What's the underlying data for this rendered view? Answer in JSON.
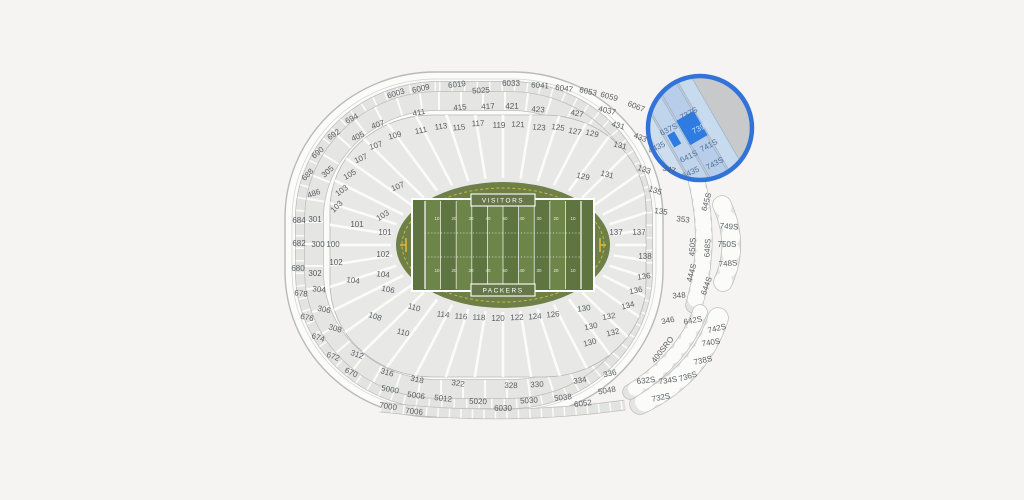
{
  "canvas": {
    "background": "#f5f4f2",
    "section_block_color": "#e4e4e2",
    "section_outline_color": "#bdbdbd",
    "label_color": "#5a5e63"
  },
  "field": {
    "visitors_label": "VISITORS",
    "packers_label": "PACKERS",
    "oval_color": "#6e8048",
    "stripe_dark": "#5e7441",
    "stripe_light": "#6e8549",
    "dashed_border_color": "#c9b93f",
    "goalpost_color": "#ddba3a"
  },
  "highlight": {
    "selected_section": "739S",
    "selected_fill": "#2e7ce1",
    "ring_color": "#3173d9",
    "tint_fill": "#b9cfe9",
    "tint_fill_alt": "#c6d8ee",
    "outside_gray": "#c7c9ca",
    "center_x": 700,
    "center_y": 128,
    "radius": 52
  },
  "labels": [
    {
      "t": "6003",
      "x": 396,
      "y": 94,
      "r": -18
    },
    {
      "t": "6009",
      "x": 421,
      "y": 89,
      "r": -13
    },
    {
      "t": "6019",
      "x": 457,
      "y": 85,
      "r": -7
    },
    {
      "t": "5025",
      "x": 481,
      "y": 91,
      "r": -3
    },
    {
      "t": "6033",
      "x": 511,
      "y": 84,
      "r": 0
    },
    {
      "t": "6041",
      "x": 540,
      "y": 86,
      "r": 4
    },
    {
      "t": "6047",
      "x": 564,
      "y": 89,
      "r": 8
    },
    {
      "t": "6053",
      "x": 588,
      "y": 92,
      "r": 12
    },
    {
      "t": "6059",
      "x": 609,
      "y": 97,
      "r": 16
    },
    {
      "t": "6067",
      "x": 636,
      "y": 107,
      "r": 22
    },
    {
      "t": "405",
      "x": 358,
      "y": 137,
      "r": -24
    },
    {
      "t": "407",
      "x": 378,
      "y": 125,
      "r": -18
    },
    {
      "t": "411",
      "x": 419,
      "y": 113,
      "r": -11
    },
    {
      "t": "415",
      "x": 460,
      "y": 108,
      "r": -6
    },
    {
      "t": "417",
      "x": 488,
      "y": 107,
      "r": -3
    },
    {
      "t": "421",
      "x": 512,
      "y": 107,
      "r": 0
    },
    {
      "t": "423",
      "x": 538,
      "y": 110,
      "r": 4
    },
    {
      "t": "427",
      "x": 577,
      "y": 114,
      "r": 9
    },
    {
      "t": "4037",
      "x": 607,
      "y": 111,
      "r": 13
    },
    {
      "t": "431",
      "x": 618,
      "y": 126,
      "r": 16
    },
    {
      "t": "433",
      "x": 640,
      "y": 138,
      "r": 22
    },
    {
      "t": "694",
      "x": 352,
      "y": 119,
      "r": -28
    },
    {
      "t": "692",
      "x": 334,
      "y": 135,
      "r": -34
    },
    {
      "t": "690",
      "x": 318,
      "y": 153,
      "r": -40
    },
    {
      "t": "688",
      "x": 308,
      "y": 175,
      "r": -46
    },
    {
      "t": "486",
      "x": 314,
      "y": 194,
      "r": -20
    },
    {
      "t": "684",
      "x": 299,
      "y": 221,
      "r": 0
    },
    {
      "t": "682",
      "x": 299,
      "y": 244,
      "r": 0
    },
    {
      "t": "680",
      "x": 298,
      "y": 269,
      "r": 0
    },
    {
      "t": "678",
      "x": 301,
      "y": 294,
      "r": 6
    },
    {
      "t": "676",
      "x": 307,
      "y": 318,
      "r": 12
    },
    {
      "t": "674",
      "x": 318,
      "y": 338,
      "r": 18
    },
    {
      "t": "672",
      "x": 333,
      "y": 357,
      "r": 22
    },
    {
      "t": "670",
      "x": 351,
      "y": 373,
      "r": 25
    },
    {
      "t": "305",
      "x": 328,
      "y": 172,
      "r": -42
    },
    {
      "t": "301",
      "x": 315,
      "y": 220,
      "r": 0
    },
    {
      "t": "300",
      "x": 318,
      "y": 245,
      "r": 0
    },
    {
      "t": "302",
      "x": 315,
      "y": 274,
      "r": 0
    },
    {
      "t": "304",
      "x": 319,
      "y": 290,
      "r": 6
    },
    {
      "t": "306",
      "x": 324,
      "y": 310,
      "r": 12
    },
    {
      "t": "308",
      "x": 335,
      "y": 329,
      "r": 16
    },
    {
      "t": "312",
      "x": 357,
      "y": 355,
      "r": 20
    },
    {
      "t": "316",
      "x": 387,
      "y": 373,
      "r": 17
    },
    {
      "t": "318",
      "x": 417,
      "y": 380,
      "r": 13
    },
    {
      "t": "322",
      "x": 458,
      "y": 384,
      "r": 8
    },
    {
      "t": "328",
      "x": 511,
      "y": 386,
      "r": 1
    },
    {
      "t": "330",
      "x": 537,
      "y": 385,
      "r": -3
    },
    {
      "t": "334",
      "x": 580,
      "y": 381,
      "r": -8
    },
    {
      "t": "336",
      "x": 610,
      "y": 374,
      "r": -12
    },
    {
      "t": "5000",
      "x": 390,
      "y": 390,
      "r": 11
    },
    {
      "t": "5006",
      "x": 416,
      "y": 396,
      "r": 8
    },
    {
      "t": "5012",
      "x": 443,
      "y": 399,
      "r": 6
    },
    {
      "t": "5020",
      "x": 478,
      "y": 402,
      "r": 2
    },
    {
      "t": "5030",
      "x": 529,
      "y": 401,
      "r": -3
    },
    {
      "t": "5038",
      "x": 563,
      "y": 398,
      "r": -6
    },
    {
      "t": "5048",
      "x": 607,
      "y": 391,
      "r": -10
    },
    {
      "t": "7000",
      "x": 388,
      "y": 407,
      "r": 9
    },
    {
      "t": "7006",
      "x": 414,
      "y": 412,
      "r": 6
    },
    {
      "t": "6030",
      "x": 503,
      "y": 409,
      "r": 0
    },
    {
      "t": "6052",
      "x": 583,
      "y": 404,
      "r": -7
    },
    {
      "t": "109",
      "x": 395,
      "y": 136,
      "r": -15
    },
    {
      "t": "111",
      "x": 421,
      "y": 131,
      "r": -11
    },
    {
      "t": "113",
      "x": 441,
      "y": 127,
      "r": -8
    },
    {
      "t": "115",
      "x": 459,
      "y": 128,
      "r": -5
    },
    {
      "t": "117",
      "x": 478,
      "y": 124,
      "r": -2
    },
    {
      "t": "119",
      "x": 499,
      "y": 126,
      "r": 0
    },
    {
      "t": "121",
      "x": 518,
      "y": 125,
      "r": 2
    },
    {
      "t": "123",
      "x": 539,
      "y": 128,
      "r": 5
    },
    {
      "t": "125",
      "x": 558,
      "y": 128,
      "r": 8
    },
    {
      "t": "127",
      "x": 575,
      "y": 132,
      "r": 11
    },
    {
      "t": "129",
      "x": 592,
      "y": 134,
      "r": 13
    },
    {
      "t": "107",
      "x": 376,
      "y": 146,
      "r": -18
    },
    {
      "t": "107",
      "x": 361,
      "y": 159,
      "r": -24
    },
    {
      "t": "105",
      "x": 350,
      "y": 175,
      "r": -30
    },
    {
      "t": "103",
      "x": 342,
      "y": 191,
      "r": -36
    },
    {
      "t": "103",
      "x": 337,
      "y": 207,
      "r": -44
    },
    {
      "t": "107",
      "x": 398,
      "y": 187,
      "r": -22
    },
    {
      "t": "103",
      "x": 383,
      "y": 216,
      "r": -32
    },
    {
      "t": "101",
      "x": 357,
      "y": 225,
      "r": 0
    },
    {
      "t": "101",
      "x": 385,
      "y": 233,
      "r": 0
    },
    {
      "t": "100",
      "x": 333,
      "y": 245,
      "r": 0
    },
    {
      "t": "102",
      "x": 336,
      "y": 263,
      "r": 0
    },
    {
      "t": "102",
      "x": 383,
      "y": 255,
      "r": 0
    },
    {
      "t": "104",
      "x": 353,
      "y": 281,
      "r": 8
    },
    {
      "t": "104",
      "x": 383,
      "y": 275,
      "r": 6
    },
    {
      "t": "106",
      "x": 388,
      "y": 290,
      "r": 12
    },
    {
      "t": "108",
      "x": 375,
      "y": 317,
      "r": 18
    },
    {
      "t": "110",
      "x": 414,
      "y": 308,
      "r": 16
    },
    {
      "t": "110",
      "x": 403,
      "y": 333,
      "r": 14
    },
    {
      "t": "114",
      "x": 443,
      "y": 315,
      "r": 6
    },
    {
      "t": "116",
      "x": 461,
      "y": 317,
      "r": 4
    },
    {
      "t": "118",
      "x": 479,
      "y": 318,
      "r": 2
    },
    {
      "t": "120",
      "x": 498,
      "y": 319,
      "r": 0
    },
    {
      "t": "122",
      "x": 517,
      "y": 318,
      "r": -2
    },
    {
      "t": "124",
      "x": 535,
      "y": 317,
      "r": -4
    },
    {
      "t": "126",
      "x": 553,
      "y": 315,
      "r": -6
    },
    {
      "t": "129",
      "x": 583,
      "y": 177,
      "r": 12
    },
    {
      "t": "131",
      "x": 607,
      "y": 175,
      "r": 14
    },
    {
      "t": "131",
      "x": 620,
      "y": 146,
      "r": 14
    },
    {
      "t": "133",
      "x": 644,
      "y": 170,
      "r": 18
    },
    {
      "t": "135",
      "x": 655,
      "y": 191,
      "r": 18
    },
    {
      "t": "135",
      "x": 661,
      "y": 212,
      "r": 8
    },
    {
      "t": "137",
      "x": 616,
      "y": 233,
      "r": 0
    },
    {
      "t": "137",
      "x": 639,
      "y": 233,
      "r": 0
    },
    {
      "t": "138",
      "x": 645,
      "y": 257,
      "r": 0
    },
    {
      "t": "136",
      "x": 644,
      "y": 277,
      "r": -8
    },
    {
      "t": "136",
      "x": 636,
      "y": 291,
      "r": -12
    },
    {
      "t": "134",
      "x": 628,
      "y": 306,
      "r": -15
    },
    {
      "t": "132",
      "x": 609,
      "y": 317,
      "r": -10
    },
    {
      "t": "132",
      "x": 613,
      "y": 333,
      "r": -14
    },
    {
      "t": "130",
      "x": 584,
      "y": 309,
      "r": -8
    },
    {
      "t": "130",
      "x": 591,
      "y": 327,
      "r": -12
    },
    {
      "t": "130",
      "x": 590,
      "y": 343,
      "r": -15
    },
    {
      "t": "347",
      "x": 669,
      "y": 170,
      "r": 14
    },
    {
      "t": "353",
      "x": 683,
      "y": 220,
      "r": 6
    },
    {
      "t": "348",
      "x": 679,
      "y": 296,
      "r": -4
    },
    {
      "t": "346",
      "x": 668,
      "y": 321,
      "r": -12
    },
    {
      "t": "645S",
      "x": 707,
      "y": 202,
      "r": -75
    },
    {
      "t": "450S",
      "x": 693,
      "y": 247,
      "r": -87
    },
    {
      "t": "444S",
      "x": 692,
      "y": 273,
      "r": -75
    },
    {
      "t": "648S",
      "x": 708,
      "y": 248,
      "r": -87
    },
    {
      "t": "644S",
      "x": 707,
      "y": 286,
      "r": -70
    },
    {
      "t": "749S",
      "x": 729,
      "y": 227,
      "r": 4
    },
    {
      "t": "750S",
      "x": 727,
      "y": 245,
      "r": 0
    },
    {
      "t": "748S",
      "x": 728,
      "y": 264,
      "r": -4
    },
    {
      "t": "642S",
      "x": 693,
      "y": 321,
      "r": -10
    },
    {
      "t": "742S",
      "x": 717,
      "y": 329,
      "r": -14
    },
    {
      "t": "740S",
      "x": 711,
      "y": 343,
      "r": -9
    },
    {
      "t": "738S",
      "x": 703,
      "y": 361,
      "r": -13
    },
    {
      "t": "736S",
      "x": 688,
      "y": 377,
      "r": -17
    },
    {
      "t": "734S",
      "x": 668,
      "y": 381,
      "r": -9
    },
    {
      "t": "632S",
      "x": 646,
      "y": 381,
      "r": -7
    },
    {
      "t": "732S",
      "x": 661,
      "y": 398,
      "r": -11
    },
    {
      "t": "400SRO",
      "x": 663,
      "y": 350,
      "r": -52
    },
    {
      "t": "737S",
      "x": 689,
      "y": 114,
      "r": -28,
      "c": "hl"
    },
    {
      "t": "637S",
      "x": 669,
      "y": 130,
      "r": -26,
      "c": "hl"
    },
    {
      "t": "739S",
      "x": 701,
      "y": 128,
      "r": -28,
      "c": "hlsel"
    },
    {
      "t": "741S",
      "x": 709,
      "y": 146,
      "r": -28,
      "c": "hl"
    },
    {
      "t": "641S",
      "x": 689,
      "y": 157,
      "r": -26,
      "c": "hl"
    },
    {
      "t": "743S",
      "x": 715,
      "y": 164,
      "r": -28,
      "c": "hl"
    },
    {
      "t": "4435",
      "x": 657,
      "y": 148,
      "r": -26,
      "c": "hl"
    },
    {
      "t": "6435",
      "x": 691,
      "y": 173,
      "r": -26,
      "c": "hl"
    },
    {
      "t": "10",
      "x": 437,
      "y": 219,
      "r": 0,
      "c": "yard"
    },
    {
      "t": "20",
      "x": 454,
      "y": 219,
      "r": 0,
      "c": "yard"
    },
    {
      "t": "30",
      "x": 471,
      "y": 219,
      "r": 0,
      "c": "yard"
    },
    {
      "t": "40",
      "x": 488,
      "y": 219,
      "r": 0,
      "c": "yard"
    },
    {
      "t": "50",
      "x": 505,
      "y": 219,
      "r": 0,
      "c": "yard"
    },
    {
      "t": "40",
      "x": 522,
      "y": 219,
      "r": 0,
      "c": "yard"
    },
    {
      "t": "30",
      "x": 539,
      "y": 219,
      "r": 0,
      "c": "yard"
    },
    {
      "t": "20",
      "x": 556,
      "y": 219,
      "r": 0,
      "c": "yard"
    },
    {
      "t": "10",
      "x": 573,
      "y": 219,
      "r": 0,
      "c": "yard"
    },
    {
      "t": "10",
      "x": 437,
      "y": 271,
      "r": 0,
      "c": "yard"
    },
    {
      "t": "20",
      "x": 454,
      "y": 271,
      "r": 0,
      "c": "yard"
    },
    {
      "t": "30",
      "x": 471,
      "y": 271,
      "r": 0,
      "c": "yard"
    },
    {
      "t": "40",
      "x": 488,
      "y": 271,
      "r": 0,
      "c": "yard"
    },
    {
      "t": "50",
      "x": 505,
      "y": 271,
      "r": 0,
      "c": "yard"
    },
    {
      "t": "40",
      "x": 522,
      "y": 271,
      "r": 0,
      "c": "yard"
    },
    {
      "t": "30",
      "x": 539,
      "y": 271,
      "r": 0,
      "c": "yard"
    },
    {
      "t": "20",
      "x": 556,
      "y": 271,
      "r": 0,
      "c": "yard"
    },
    {
      "t": "10",
      "x": 573,
      "y": 271,
      "r": 0,
      "c": "yard"
    }
  ]
}
